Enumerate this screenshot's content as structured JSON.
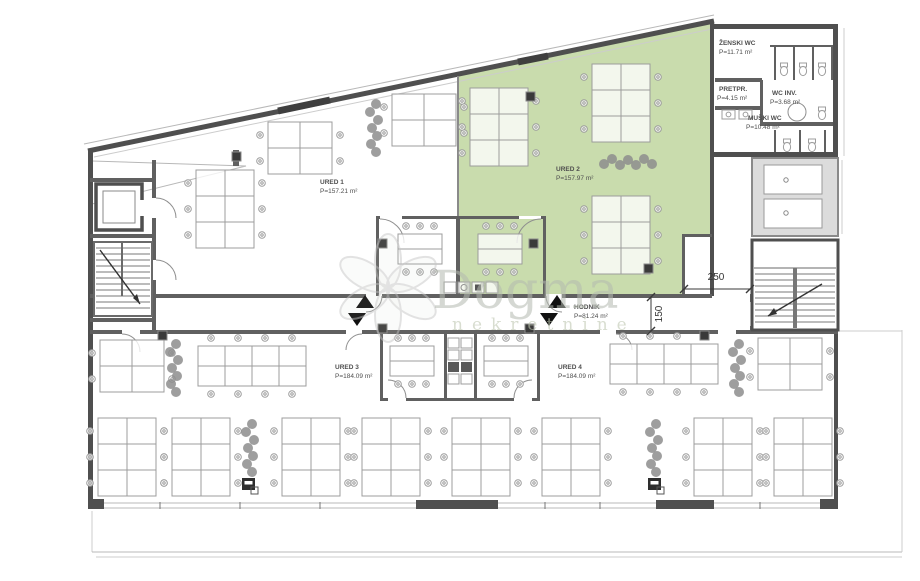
{
  "plan": {
    "type": "floor-plan",
    "watermark": {
      "brand": "Dogma",
      "subtitle": "nekretnine"
    },
    "rooms": [
      {
        "name": "URED 1",
        "area": "P=157.21 m²"
      },
      {
        "name": "URED 2",
        "area": "P=157.97 m²",
        "highlighted": true
      },
      {
        "name": "URED 3",
        "area": "P=184.09 m²"
      },
      {
        "name": "URED 4",
        "area": "P=184.09 m²"
      },
      {
        "name": "HODNIK",
        "area": "P=81.24 m²"
      },
      {
        "name": "ŽENSKI WC",
        "area": "P=11.71 m²"
      },
      {
        "name": "PRETPR.",
        "area": "P=4.15 m²"
      },
      {
        "name": "WC INV.",
        "area": "P=3.68 m²"
      },
      {
        "name": "MUŠKI WC",
        "area": "P=10.48 m²"
      }
    ],
    "dimensions": [
      {
        "label": "250",
        "orientation": "horizontal"
      },
      {
        "label": "150",
        "orientation": "vertical"
      }
    ],
    "colors": {
      "highlight_fill": "#c9dcad",
      "wall": "#4f4f4f",
      "furniture_line": "#9c9c9c"
    }
  }
}
